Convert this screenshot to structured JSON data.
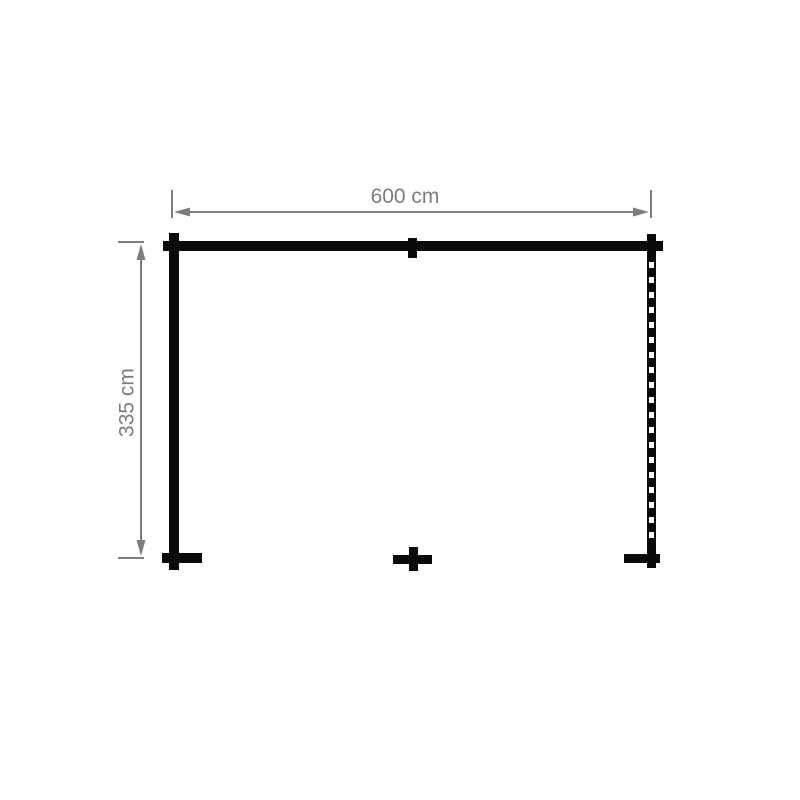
{
  "diagram": {
    "type": "floor-plan",
    "width_dimension": {
      "label": "600 cm",
      "value_cm": 600
    },
    "depth_dimension": {
      "label": "335 cm",
      "value_cm": 335
    },
    "colors": {
      "wall": "#0a0a0a",
      "dimension": "#7d7d7d",
      "background": "#ffffff"
    }
  }
}
